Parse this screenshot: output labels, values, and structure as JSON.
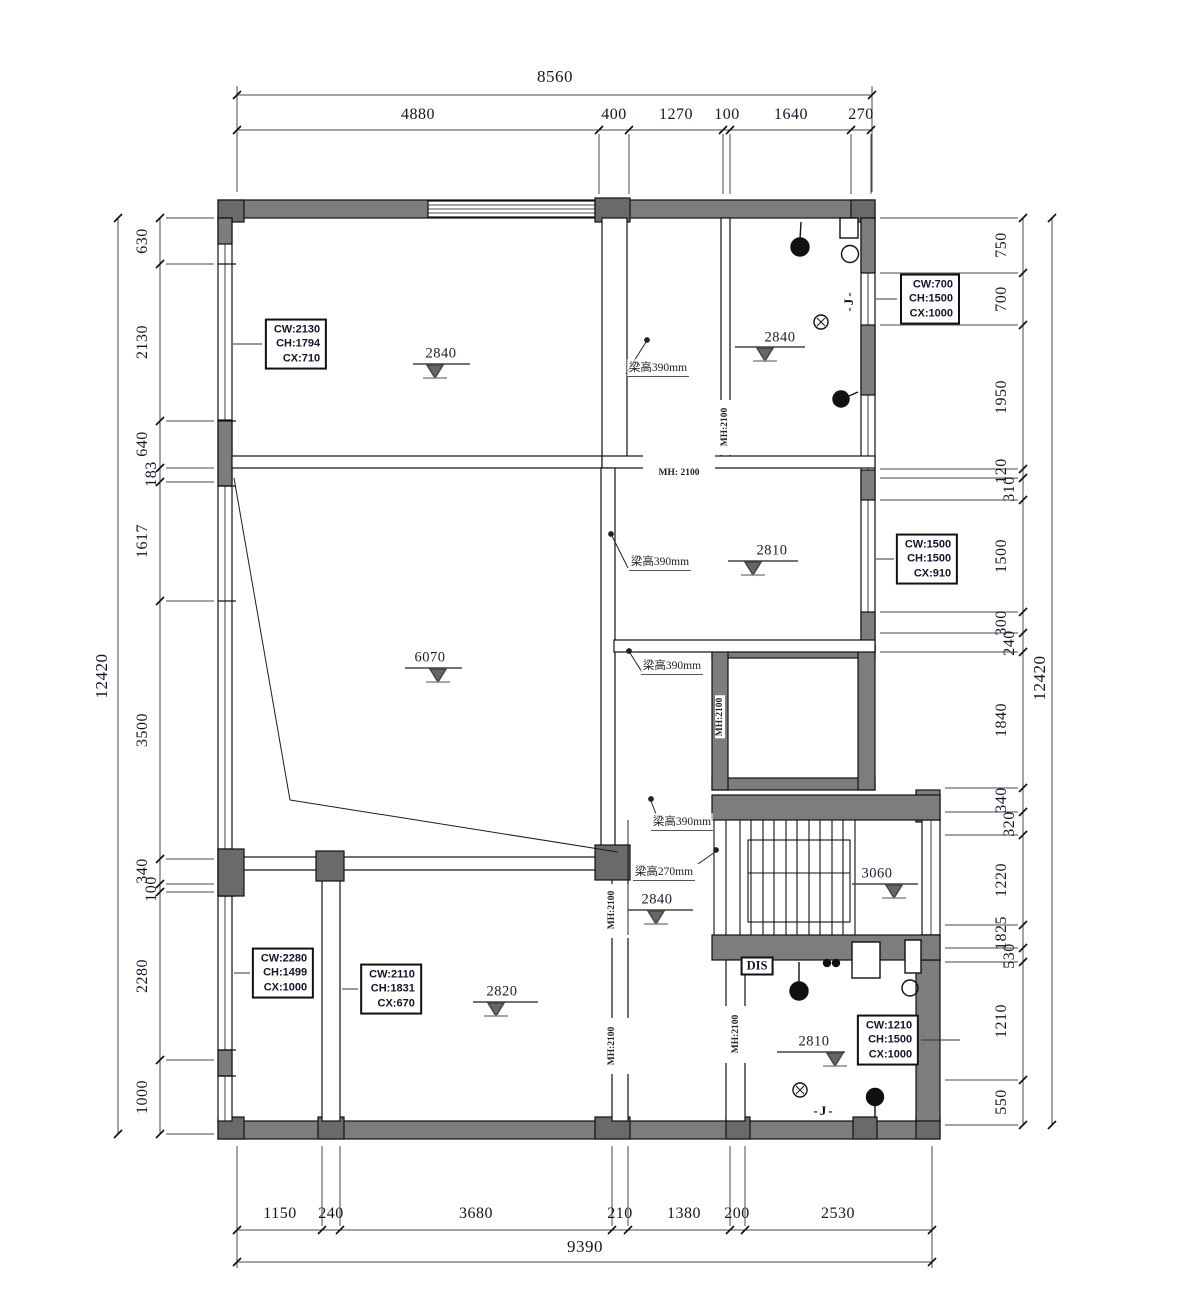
{
  "drawing": {
    "type": "architectural floor plan"
  },
  "dimensions": {
    "top": {
      "overall": "8560",
      "segments": [
        "4880",
        "400",
        "1270",
        "100",
        "1640",
        "270"
      ]
    },
    "bottom": {
      "overall": "9390",
      "segments": [
        "1150",
        "240",
        "3680",
        "210",
        "1380",
        "200",
        "2530"
      ]
    },
    "left": {
      "overall": "12420",
      "segments": [
        "630",
        "2130",
        "640",
        "183",
        "1617",
        "3500",
        "340",
        "100",
        "2280",
        "1000"
      ]
    },
    "right": {
      "overall": "12420",
      "segments": [
        "750",
        "700",
        "1950",
        "120",
        "310",
        "1500",
        "300",
        "240",
        "1840",
        "340",
        "320",
        "1220",
        "1825",
        "530",
        "1210",
        "550"
      ]
    }
  },
  "window_callouts": [
    {
      "cw": "CW:2130",
      "ch": "CH:1794",
      "cx": "CX:710"
    },
    {
      "cw": "CW:700",
      "ch": "CH:1500",
      "cx": "CX:1000"
    },
    {
      "cw": "CW:1500",
      "ch": "CH:1500",
      "cx": "CX:910"
    },
    {
      "cw": "CW:2280",
      "ch": "CH:1499",
      "cx": "CX:1000"
    },
    {
      "cw": "CW:2110",
      "ch": "CH:1831",
      "cx": "CX:670"
    },
    {
      "cw": "CW:1210",
      "ch": "CH:1500",
      "cx": "CX:1000"
    }
  ],
  "elevation_markers": {
    "top_left_room": "2840",
    "top_right_bath": "2840",
    "mid_right_room": "2810",
    "living_room": "6070",
    "stair_lower": "2840",
    "stair_upper": "3060",
    "bottom_mid_room": "2820",
    "bottom_right_bath": "2810"
  },
  "beam_labels": [
    "梁高390mm",
    "梁高390mm",
    "梁高390mm",
    "梁高390mm",
    "梁高270mm"
  ],
  "door_height_labels": {
    "horizontal": "MH: 2100",
    "vertical": "MH:2100"
  },
  "annotations": {
    "dis": "DIS",
    "j_top": "-J-",
    "j_bottom": "-J-"
  },
  "colors": {
    "wall_fill": "#7d7d7d",
    "column_fill": "#6a6a6a",
    "line": "#1c1c1c"
  }
}
